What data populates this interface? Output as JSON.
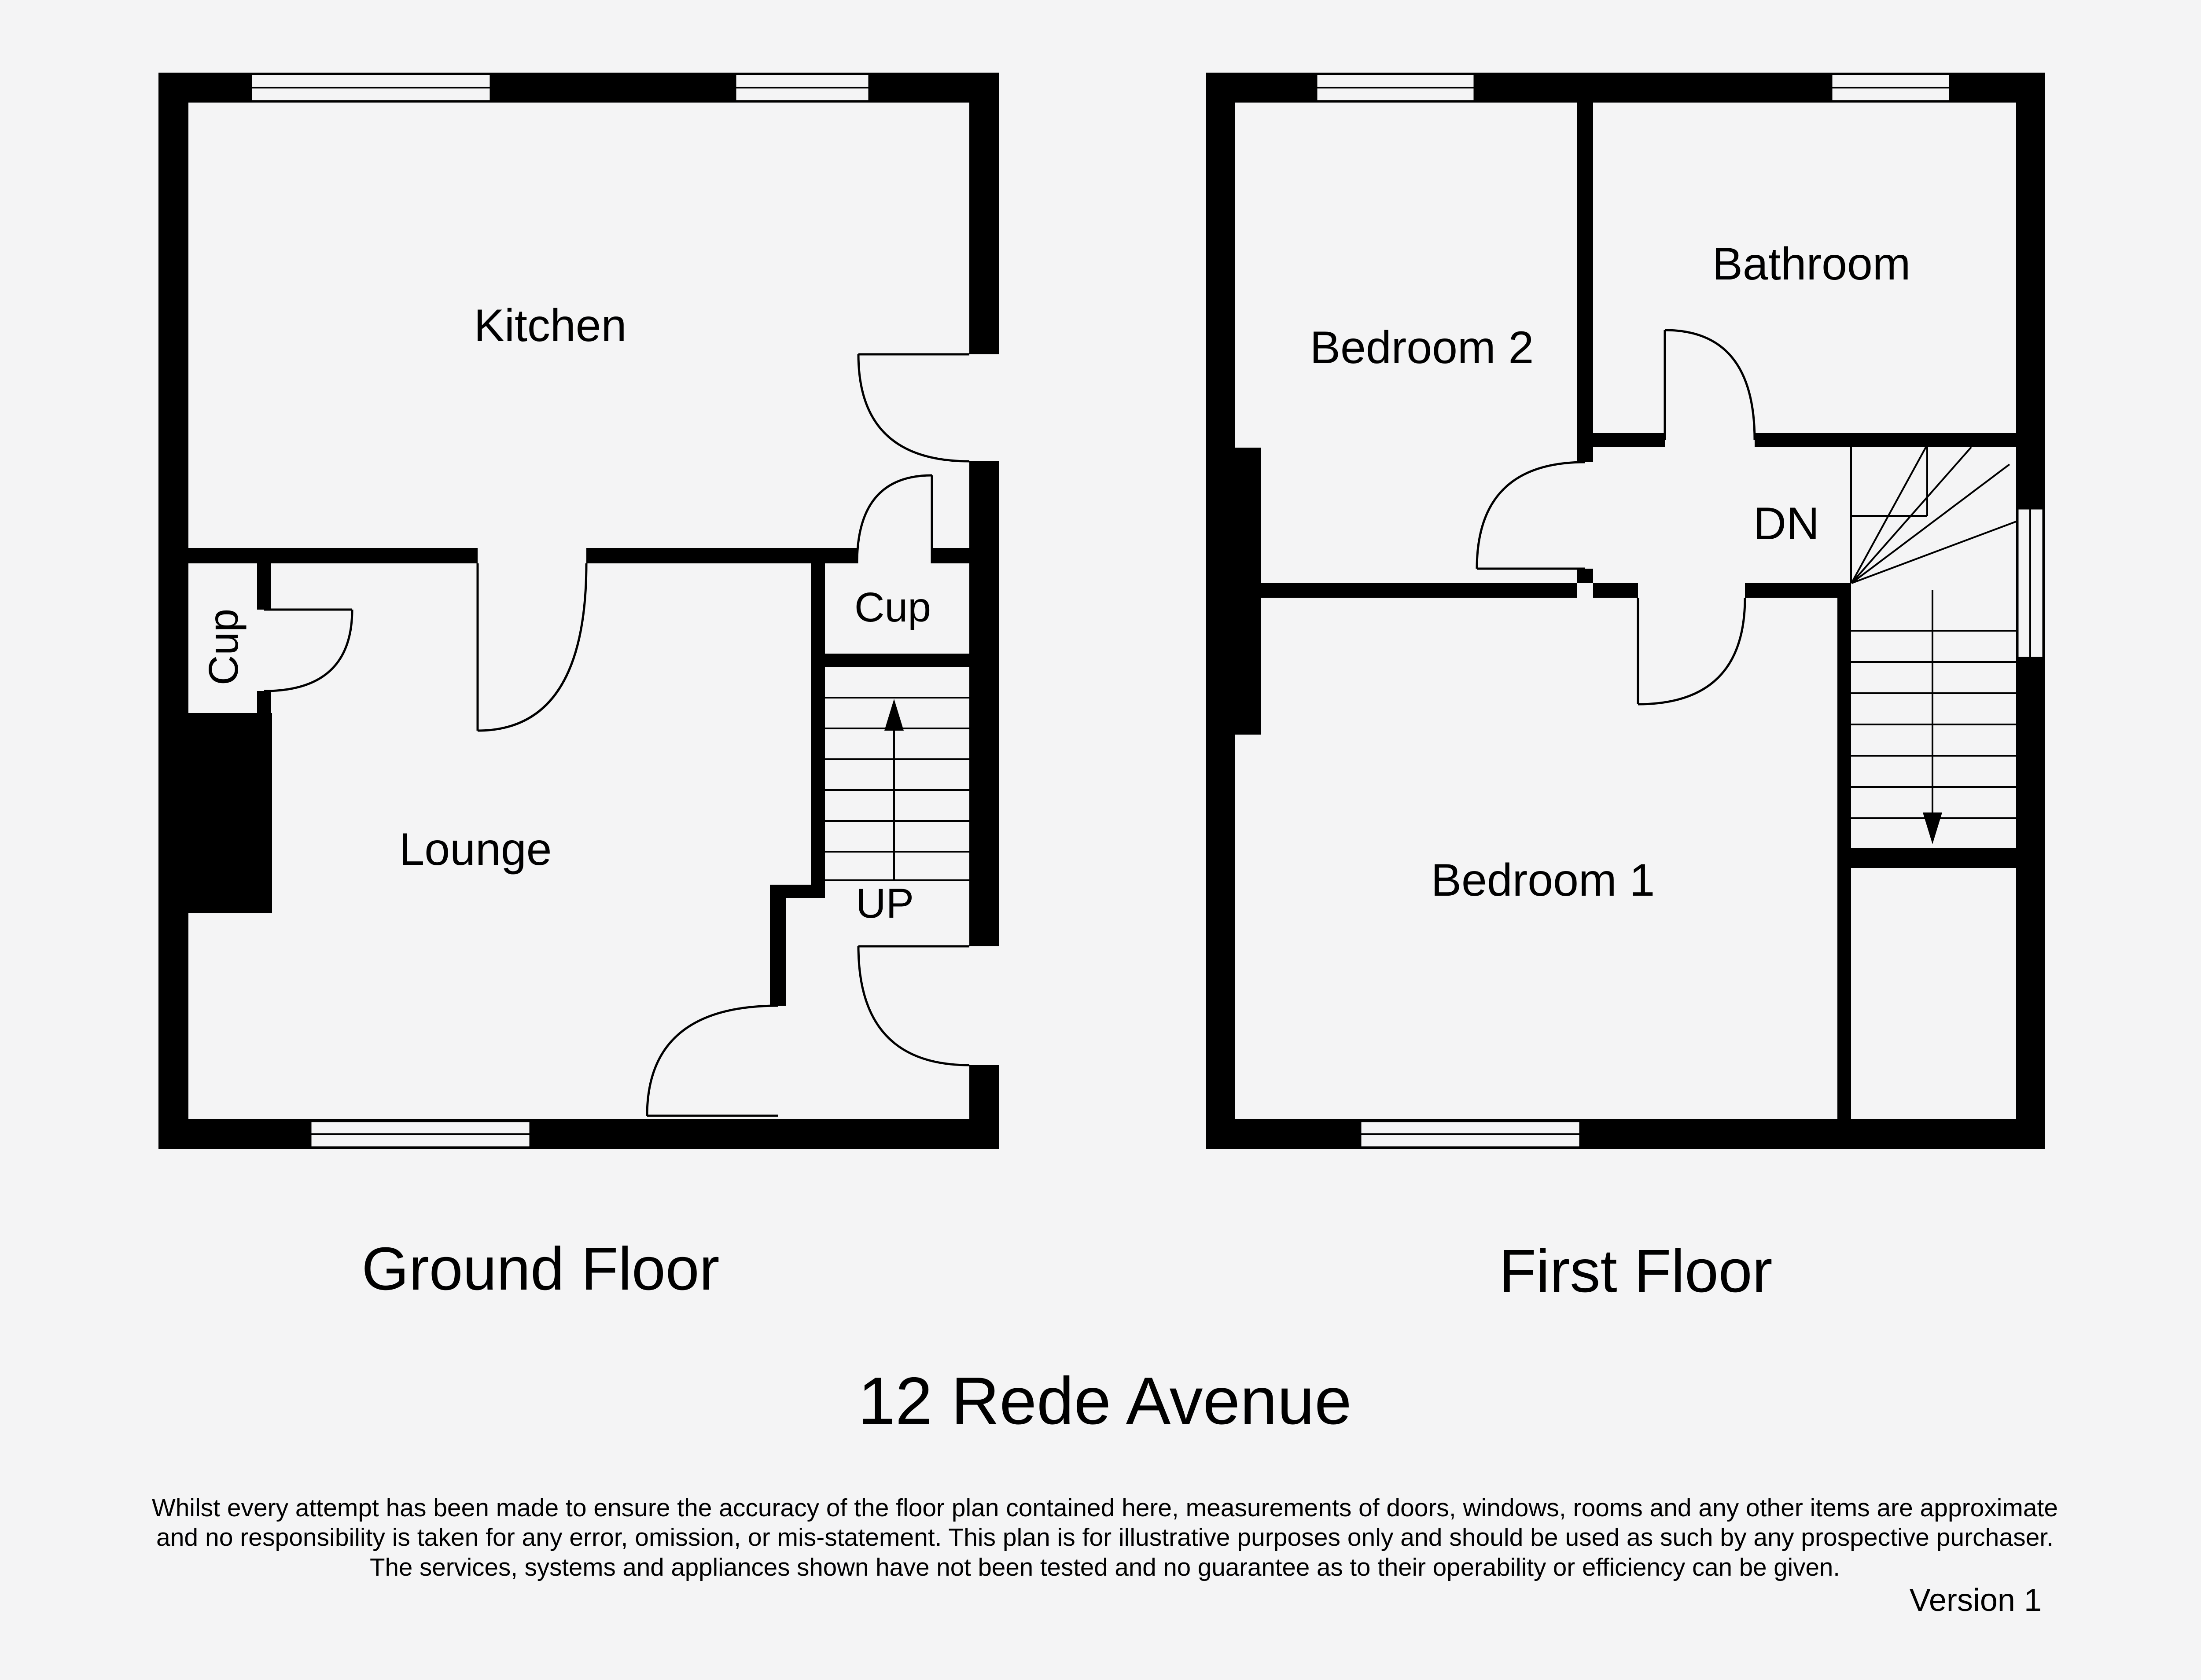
{
  "page": {
    "background_color": "#f4f4f5",
    "ink_color": "#000000"
  },
  "ground_floor": {
    "title": "Ground Floor",
    "rooms": {
      "kitchen": "Kitchen",
      "lounge": "Lounge",
      "cupboard_left": "Cup",
      "cupboard_stairs": "Cup",
      "stairs_direction": "UP"
    }
  },
  "first_floor": {
    "title": "First Floor",
    "rooms": {
      "bedroom2": "Bedroom 2",
      "bathroom": "Bathroom",
      "bedroom1": "Bedroom 1",
      "stairs_direction": "DN"
    }
  },
  "footer": {
    "address": "12 Rede Avenue",
    "disclaimer": {
      "line1": "Whilst every attempt has been made to ensure the accuracy of the floor plan contained here, measurements of doors, windows, rooms and any other items are approximate",
      "line2": "and no responsibility is taken for any error, omission, or mis-statement. This plan is for illustrative purposes only and should be used as such by any prospective purchaser.",
      "line3": "The services, systems and appliances shown have not been tested and no guarantee as to their operability or efficiency can be given."
    },
    "version": "Version 1"
  }
}
